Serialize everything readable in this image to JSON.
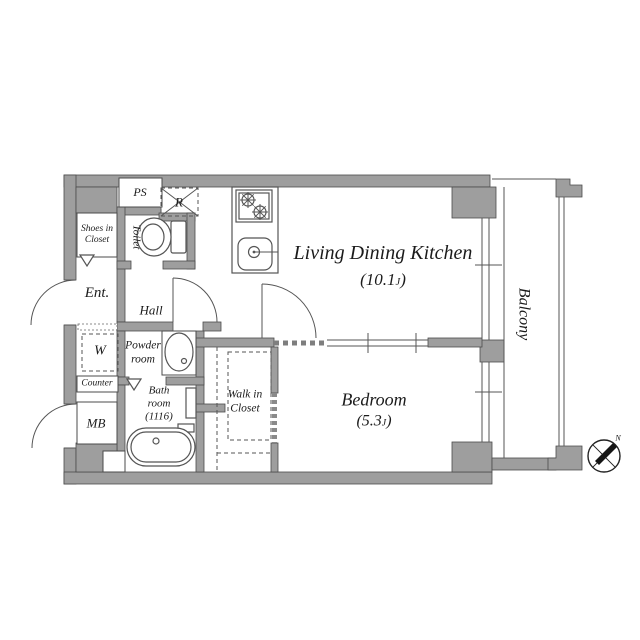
{
  "rooms": {
    "ldk": {
      "name": "Living Dining Kitchen",
      "area_prefix": "(10.1",
      "area_unit": "J",
      "area_suffix": ")"
    },
    "bedroom": {
      "name": "Bedroom",
      "area_prefix": "(5.3",
      "area_unit": "J",
      "area_suffix": ")"
    },
    "balcony": {
      "name": "Balcony"
    },
    "entrance": {
      "name": "Ent."
    },
    "hall": {
      "name": "Hall"
    },
    "toilet": {
      "name": "Toilet"
    },
    "powder_room": {
      "line1": "Powder",
      "line2": "room"
    },
    "bath_room": {
      "line1": "Bath",
      "line2": "room",
      "line3": "(1116)"
    },
    "walk_in_closet": {
      "line1": "Walk in",
      "line2": "Closet"
    },
    "shoes_in_closet": {
      "line1": "Shoes in",
      "line2": "Closet"
    }
  },
  "fixtures": {
    "pipe_space": "PS",
    "refrigerator": "R",
    "washer": "W",
    "counter": "Counter",
    "meter_box": "MB"
  },
  "compass": {
    "north": "N"
  },
  "colors": {
    "wall_fill": "#9e9e9e",
    "wall_outline": "#4b4b4b",
    "line": "#555555",
    "text": "#1b1b1b",
    "background": "#ffffff"
  }
}
